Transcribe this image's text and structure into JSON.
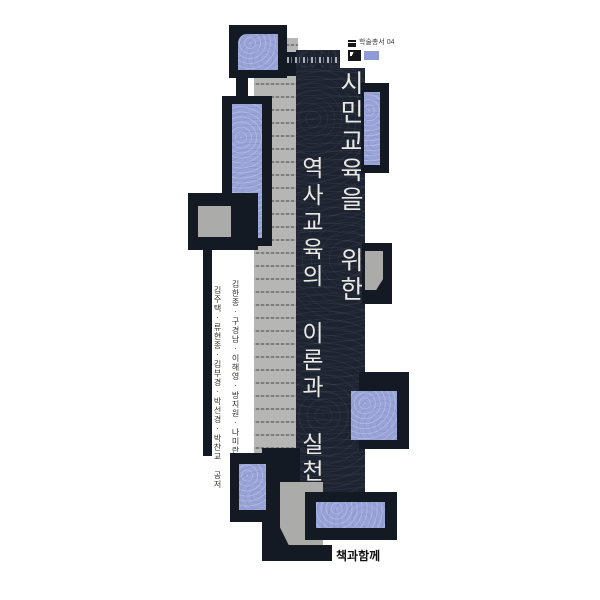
{
  "book_cover": {
    "series_mark": {
      "label": "학술총서 04"
    },
    "title": {
      "line1": "시민교육을 위한",
      "line2": "역사교육의 이론과 실천",
      "full": "시민교육을 위한 역사교육의 이론과 실천"
    },
    "authors": {
      "line1": "김한종·구경남·이해영·방지원·나미란",
      "line2": "김주택·류현종·김부경·박선경·박찬교 공저"
    },
    "publisher": {
      "name": "책과함께"
    },
    "colors": {
      "accent_blue": "#98a3d7",
      "band_navy": "#1d2330",
      "frame_black": "#141a24",
      "page_gray": "#b6b6b4",
      "title_text": "#e8e9e4"
    }
  }
}
